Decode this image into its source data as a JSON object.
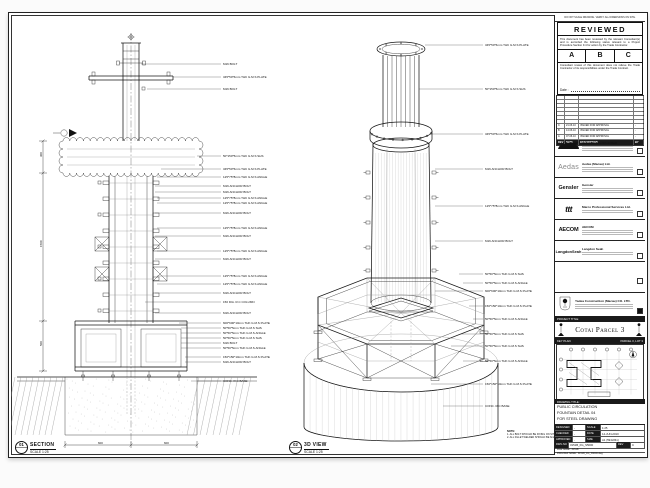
{
  "sheet": {
    "views": [
      {
        "num": "01",
        "name": "SECTION",
        "scale": "SCALE 1:25"
      },
      {
        "num": "02",
        "name": "3D VIEW",
        "scale": "SCALE 1:25"
      }
    ],
    "note": {
      "title": "NOTE:",
      "lines": [
        "1. ALL BOLT SHOULD BE FIXING ON SITE.",
        "2. ALL FILLET WELDED SHOULD BE 6mm THK."
      ]
    },
    "dims": {
      "bottom": [
        "600",
        "600"
      ],
      "left": [
        "300",
        "1500",
        "500"
      ]
    },
    "section_annotations": [
      "M16 BOLT",
      "345*50*6mm THK G.M.S PLATE",
      "M16 BOLT",
      "50*150*5mm THK G.M.S SHS",
      "345*50*6mm THK G.M.S PLATE",
      "125*75*8mm THK G.M.S ANGLE",
      "M16 ANCHOR BOLT",
      "M16 ANCHOR BOLT",
      "125*75*8mm THK G.M.S ANGLE",
      "125*75*8mm THK G.M.S ANGLE",
      "M16 ANCHOR BOLT",
      "125*75*8mm THK G.M.S ANGLE",
      "M16 ANCHOR BOLT",
      "125*75*8mm THK G.M.S ANGLE",
      "M16 ANCHOR BOLT",
      "125*75*8mm THK G.M.S ANGLE",
      "125*75*8mm THK G.M.S ANGLE",
      "M16 ANCHOR BOLT",
      "150 DIA. R.C COLUMN",
      "M16 ANCHOR BOLT",
      "600*600*10mm THK G.M.S PLATE",
      "50*50*5mm THK G.M.S SHS",
      "50*50*5mm THK G.M.S ANGLE",
      "50*50*5mm THK G.M.S SHS",
      "M16 BOLT",
      "50*50*5mm THK G.M.S ANGLE",
      "150*150*10mm THK G.M.S PLATE",
      "M16 ANCHOR BOLT",
      "CONC. R.C BASE"
    ],
    "view3d_annotations": [
      "345*50*6mm THK G.M.S PLATE",
      "50*150*5mm THK G.M.S SHS",
      "345*50*6mm THK G.M.S PLATE",
      "M16 ANCHOR BOLT",
      "125*75*8mm THK G.M.S ANGLE",
      "M16 ANCHOR BOLT",
      "50*50*5mm THK G.M.S SHS",
      "50*50*5mm THK G.M.S ANGLE",
      "600*600*10mm THK G.M.S PLATE",
      "150*150*10mm THK G.M.S PLATE",
      "50*50*5mm THK G.M.S ANGLE",
      "50*50*5mm THK G.M.S SHS",
      "50*50*5mm THK G.M.S SHS",
      "50*50*5mm THK G.M.S ANGLE",
      "150*150*10mm THK G.M.S PLATE",
      "CONC. R.C BASE"
    ]
  },
  "titleblock": {
    "top_note": "DO NOT SCALE DRAWING. VERIFY ALL DIMENSIONS ON SITE.",
    "reviewed": {
      "title": "REVIEWED",
      "para1": "This document has been reviewed by the relevant Consultant(s) and is accorded the following status relevant to a Project Procedure Section 9.4 for action by the Trade Contractor.",
      "statuses": [
        "A",
        "B",
        "C"
      ],
      "para2": "Consultant review of this document does not relieve the Trade Contractor of its responsibilities under the Trade Contract.",
      "date_label": "Date :"
    },
    "revisions": {
      "header": [
        "REV",
        "DATE",
        "DESCRIPTION",
        "BY"
      ],
      "rows": [
        [
          "C",
          "21.06.10",
          "ISSUED FOR APPROVAL",
          "-"
        ],
        [
          "B",
          "14.06.10",
          "ISSUED FOR APPROVAL",
          "-"
        ],
        [
          "A",
          "07.06.10",
          "ISSUED FOR APPROVAL",
          "-"
        ]
      ]
    },
    "companies": [
      {
        "logo": "",
        "name": "Venetian Orient Limited"
      },
      {
        "logo": "Aedas",
        "name": "Aedas (Macau) Ltd."
      },
      {
        "logo": "Gensler",
        "name": "Gensler"
      },
      {
        "logo": "ttt",
        "name": "Marco Professional Services Ltd."
      },
      {
        "logo": "AECOM",
        "name": "AECOM"
      },
      {
        "logo": "LangdonSeah",
        "name": "Langdon Seah"
      }
    ],
    "contractor": {
      "name": "Yadea Construction (Macau) CO. LTD."
    },
    "project_title_label": "PROJECT TITLE",
    "project_title": "Cotai Parcel 3",
    "key_plan_label": "KEY PLAN",
    "key_plan_right_label": "PARCEL 3, LOT 3",
    "drawing_title_label": "DRAWING TITLE:",
    "drawing_title_lines": [
      "PUBLIC CIRCULATION",
      "FOUNTAIN DETAIL 04",
      "FOR STEEL DRAWING"
    ],
    "fields": {
      "rows": [
        [
          "DESIGNED",
          "-",
          "SCALE",
          "1:25"
        ],
        [
          "CHECKED",
          "-",
          "DATE",
          "14-JUN-2010"
        ],
        [
          "APPROVED",
          "-",
          "SIZE",
          "A1 (594x841)"
        ]
      ]
    },
    "dwg": {
      "label": "DWG NO",
      "no": "3151B_FG_S5000",
      "rev_label": "REV",
      "rev": "C"
    },
    "file_rows": [
      "FILE NAME : 3151B",
      "DWG REF NAME : 3151B_FG_S5000.dwg"
    ]
  }
}
